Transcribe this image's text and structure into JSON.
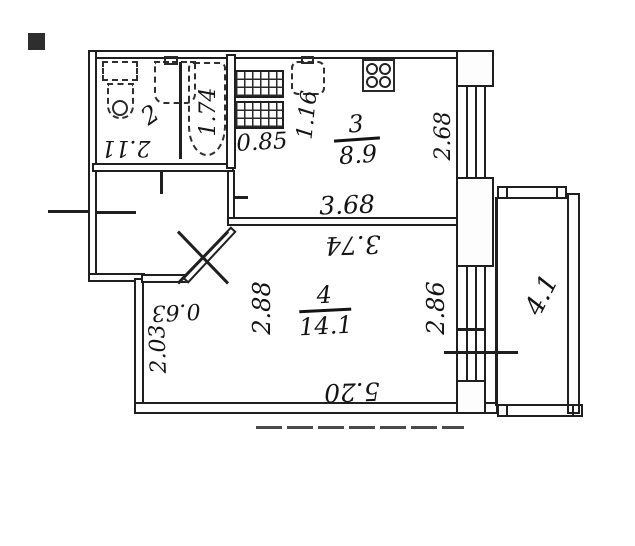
{
  "floor_plan": {
    "rooms": [
      {
        "number": "2"
      },
      {
        "number": "3",
        "area": "8.9"
      },
      {
        "number": "4",
        "area": "14.1"
      }
    ],
    "dimensions": {
      "bathroom_depth": "2.11",
      "bathtub_length": "1.74",
      "kitchen_counter_width": "0.85",
      "kitchen_sink_width": "1.16",
      "kitchen_window_wall": "2.68",
      "kitchen_width": "3.68",
      "room4_width_top": "3.74",
      "room4_left_upper": "2.88",
      "room4_right": "2.86",
      "hall_nook": "0.63",
      "room4_left_lower": "2.03",
      "room4_length": "5.20",
      "balcony_length": "4.1"
    },
    "icons": {
      "toilet": "toilet-top-view",
      "washbasin": "washbasin-top-view",
      "bathtub": "bathtub-top-view",
      "kitchen_sink": "kitchen-sink-top-view",
      "stove": "four-burner-stove",
      "counters": "hatched-kitchen-counters"
    },
    "colors": {
      "ink": "#1f1f1f",
      "paper": "#ffffff"
    }
  }
}
